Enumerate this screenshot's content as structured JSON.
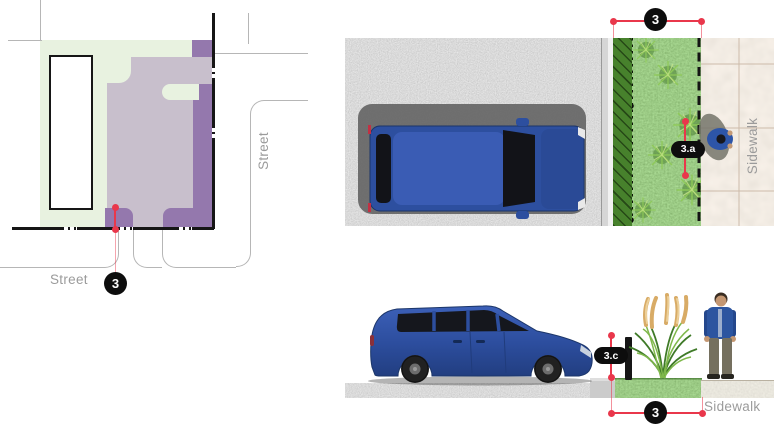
{
  "colors": {
    "dimension_red": "#e9374b",
    "badge_black": "#0d0d0d",
    "badge_text": "#ffffff",
    "label_gray": "#9b9b9b",
    "plan_mint_green": "#e8f2e0",
    "plan_lavender": "#c8bfcc",
    "plan_purple": "#9478ad",
    "street_line_black": "#161616",
    "curb_line_gray": "#b6b6b6",
    "grass_green": "#559b3a",
    "sidewalk_tan": "#e4d6c7",
    "concrete_gray": "#cfc8ba",
    "asphalt_gray": "#b5b5b5",
    "vehicle_blue": "#2d4f9f"
  },
  "site_plan": {
    "label_street_bottom": "Street",
    "label_street_right": "Street",
    "badge_setback": "3"
  },
  "plan_view": {
    "badge_width": "3",
    "badge_planting": "3.a",
    "label_sidewalk": "Sidewalk"
  },
  "elevation_view": {
    "badge_height": "3.c",
    "badge_width": "3",
    "label_sidewalk": "Sidewalk"
  }
}
